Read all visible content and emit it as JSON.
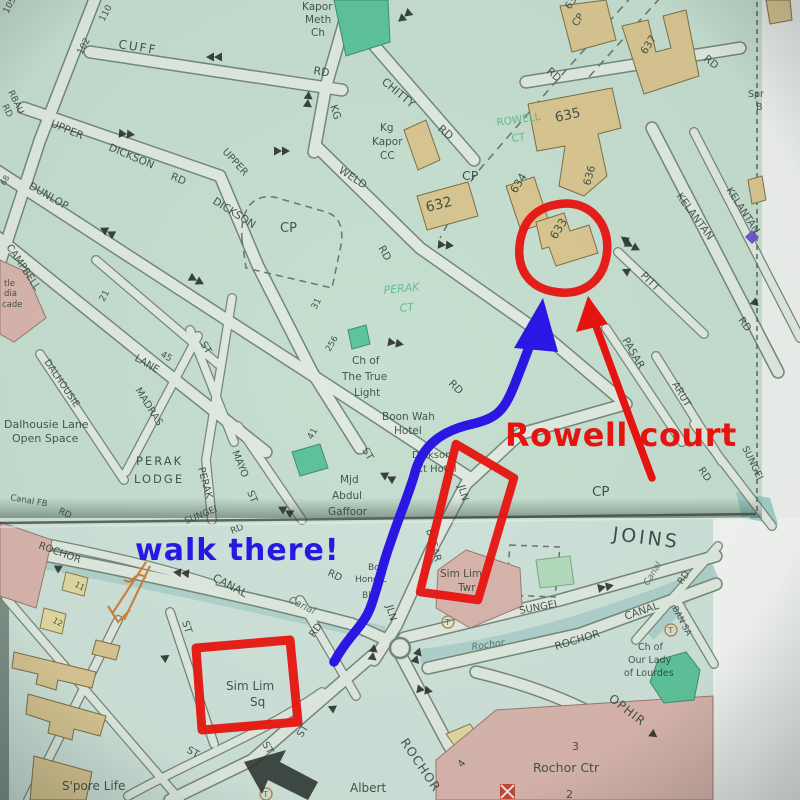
{
  "annotations": {
    "rowell_text": "Rowell court",
    "walk_text": "walk there!"
  },
  "colors": {
    "d": "#33423a",
    "g": "#58b989",
    "c": "#4d6a66",
    "j": "#2e3a35",
    "red": "#e61410",
    "blue": "#2817e2",
    "orange": "#c8772e",
    "map_bg_top": "#c6dfd0",
    "map_bg_bottom": "#cfe3da",
    "road_fill": "#e0eae0",
    "building_tan": "#d9c692",
    "building_pink": "#d9b6ae",
    "building_green": "#5ec49b"
  },
  "taxi_letter": "T",
  "taxi_stands": [
    {
      "x": 448,
      "y": 622
    },
    {
      "x": 266,
      "y": 794
    },
    {
      "x": 671,
      "y": 630
    }
  ],
  "labels": [
    {
      "t": "Kapor",
      "x": 302,
      "y": 10
    },
    {
      "t": "Meth",
      "x": 305,
      "y": 23
    },
    {
      "t": "Ch",
      "x": 311,
      "y": 36
    },
    {
      "t": "CUFF",
      "x": 118,
      "y": 48,
      "r": 9,
      "s": 12,
      "sp": 2
    },
    {
      "t": "RD",
      "x": 313,
      "y": 74,
      "r": 9,
      "s": 11
    },
    {
      "t": "110",
      "x": 104,
      "y": 22,
      "r": -62,
      "s": 9
    },
    {
      "t": "102",
      "x": 82,
      "y": 55,
      "r": -62,
      "s": 9
    },
    {
      "t": "105",
      "x": 8,
      "y": 14,
      "r": -62,
      "s": 9
    },
    {
      "t": "RBAU",
      "x": 8,
      "y": 92,
      "r": 64,
      "s": 9
    },
    {
      "t": "RD",
      "x": 2,
      "y": 106,
      "r": 64,
      "s": 9
    },
    {
      "t": "UPPER",
      "x": 50,
      "y": 126,
      "r": 23
    },
    {
      "t": "DICKSON",
      "x": 108,
      "y": 150,
      "r": 23
    },
    {
      "t": "RD",
      "x": 170,
      "y": 179,
      "r": 23
    },
    {
      "t": "UPPER",
      "x": 222,
      "y": 152,
      "r": 48,
      "s": 10
    },
    {
      "t": "DICKSON",
      "x": 212,
      "y": 203,
      "r": 32
    },
    {
      "t": "CP",
      "x": 280,
      "y": 232,
      "s": 13
    },
    {
      "t": "31",
      "x": 316,
      "y": 310,
      "r": -62,
      "s": 9
    },
    {
      "t": "DUNLOP",
      "x": 28,
      "y": 188,
      "r": 30
    },
    {
      "t": "68",
      "x": 5,
      "y": 186,
      "r": -62,
      "s": 8
    },
    {
      "t": "CAMPBELL",
      "x": 6,
      "y": 247,
      "r": 56,
      "s": 10
    },
    {
      "t": "LANE",
      "x": 134,
      "y": 360,
      "r": 30,
      "s": 10
    },
    {
      "t": "45",
      "x": 160,
      "y": 356,
      "r": 30,
      "s": 9
    },
    {
      "t": "21",
      "x": 104,
      "y": 302,
      "r": -62,
      "s": 9
    },
    {
      "t": "tle",
      "x": 4,
      "y": 286,
      "s": 8.5
    },
    {
      "t": "dia",
      "x": 4,
      "y": 296,
      "s": 8.5
    },
    {
      "t": "cade",
      "x": 2,
      "y": 307,
      "s": 8.5
    },
    {
      "t": "DALHOUSIE",
      "x": 44,
      "y": 362,
      "r": 56,
      "s": 9.5
    },
    {
      "t": "Dalhousie Lane",
      "x": 4,
      "y": 428,
      "s": 11
    },
    {
      "t": "Open Space",
      "x": 12,
      "y": 442,
      "s": 11
    },
    {
      "t": "MADRAS",
      "x": 135,
      "y": 390,
      "r": 58,
      "s": 10
    },
    {
      "t": "ST",
      "x": 200,
      "y": 344,
      "r": 58,
      "s": 10
    },
    {
      "t": "PERAK",
      "x": 136,
      "y": 465,
      "s": 11.5,
      "sp": 2
    },
    {
      "t": "LODGE",
      "x": 134,
      "y": 483,
      "s": 11.5,
      "sp": 2
    },
    {
      "t": "PERAK",
      "x": 198,
      "y": 468,
      "r": 75,
      "s": 10
    },
    {
      "t": "MAYO",
      "x": 232,
      "y": 452,
      "r": 68,
      "s": 10
    },
    {
      "t": "ST",
      "x": 247,
      "y": 492,
      "r": 68,
      "s": 10
    },
    {
      "t": "Canal FB",
      "x": 10,
      "y": 500,
      "r": 10,
      "s": 8.5
    },
    {
      "t": "RD",
      "x": 58,
      "y": 513,
      "r": 25,
      "s": 9
    },
    {
      "t": "KG",
      "x": 330,
      "y": 106,
      "r": 72
    },
    {
      "t": "CHITTY",
      "x": 381,
      "y": 83,
      "r": 40,
      "s": 11
    },
    {
      "t": "RD",
      "x": 437,
      "y": 130,
      "r": 40,
      "s": 11
    },
    {
      "t": "Kg",
      "x": 380,
      "y": 131
    },
    {
      "t": "Kapor",
      "x": 372,
      "y": 145
    },
    {
      "t": "CC",
      "x": 380,
      "y": 159
    },
    {
      "t": "WELD",
      "x": 338,
      "y": 172,
      "r": 33
    },
    {
      "t": "RD",
      "x": 378,
      "y": 248,
      "r": 60
    },
    {
      "t": "RD",
      "x": 448,
      "y": 384,
      "r": 45
    },
    {
      "t": "CP",
      "x": 462,
      "y": 180,
      "s": 12.5
    },
    {
      "t": "ROWELL",
      "x": 497,
      "y": 126,
      "r": -8,
      "c": "g",
      "s": 10.5
    },
    {
      "t": "CT",
      "x": 512,
      "y": 142,
      "r": -8,
      "c": "g",
      "s": 10.5
    },
    {
      "t": "638",
      "x": 570,
      "y": 10,
      "r": -56,
      "s": 10
    },
    {
      "t": "CP",
      "x": 577,
      "y": 27,
      "r": -56,
      "s": 10
    },
    {
      "t": "637",
      "x": 646,
      "y": 55,
      "r": -58,
      "s": 10.5
    },
    {
      "t": "RD",
      "x": 546,
      "y": 72,
      "r": 42,
      "s": 10.5
    },
    {
      "t": "RD",
      "x": 703,
      "y": 60,
      "r": 38,
      "s": 10.5
    },
    {
      "t": "635",
      "x": 556,
      "y": 122,
      "r": -12,
      "s": 13.5
    },
    {
      "t": "636",
      "x": 590,
      "y": 186,
      "r": -75,
      "s": 10.5
    },
    {
      "t": "Spr",
      "x": 748,
      "y": 97,
      "s": 9.5
    },
    {
      "t": "B",
      "x": 756,
      "y": 110,
      "s": 9.5
    },
    {
      "t": "632",
      "x": 427,
      "y": 212,
      "r": -14,
      "s": 14
    },
    {
      "t": "634",
      "x": 516,
      "y": 194,
      "r": -58,
      "s": 11
    },
    {
      "t": "633",
      "x": 556,
      "y": 240,
      "r": -58,
      "s": 11.5
    },
    {
      "t": "PERAK",
      "x": 384,
      "y": 294,
      "r": -6,
      "c": "g",
      "i": 1,
      "s": 11
    },
    {
      "t": "CT",
      "x": 400,
      "y": 312,
      "r": -6,
      "c": "g",
      "i": 1,
      "s": 11
    },
    {
      "t": "256",
      "x": 330,
      "y": 352,
      "r": -60,
      "s": 8.5
    },
    {
      "t": "Ch of",
      "x": 352,
      "y": 364
    },
    {
      "t": "The True",
      "x": 342,
      "y": 380
    },
    {
      "t": "Light",
      "x": 354,
      "y": 396
    },
    {
      "t": "Boon Wah",
      "x": 382,
      "y": 420
    },
    {
      "t": "Hotel",
      "x": 394,
      "y": 434
    },
    {
      "t": "3",
      "x": 472,
      "y": 430,
      "r": -55,
      "s": 9.5
    },
    {
      "t": "Dickson",
      "x": 412,
      "y": 458,
      "s": 10
    },
    {
      "t": "Ct Hotel",
      "x": 416,
      "y": 472,
      "s": 10
    },
    {
      "t": "Mjd",
      "x": 340,
      "y": 483
    },
    {
      "t": "Abdul",
      "x": 332,
      "y": 499
    },
    {
      "t": "Gaffoor",
      "x": 328,
      "y": 515
    },
    {
      "t": "ST",
      "x": 362,
      "y": 450,
      "r": 60,
      "s": 10
    },
    {
      "t": "41",
      "x": 312,
      "y": 440,
      "r": -60,
      "s": 9
    },
    {
      "t": "KELANTAN",
      "x": 676,
      "y": 196,
      "r": 54
    },
    {
      "t": "KELANTAN",
      "x": 726,
      "y": 190,
      "r": 57,
      "s": 10
    },
    {
      "t": "PITT",
      "x": 640,
      "y": 276,
      "r": 45
    },
    {
      "t": "PASAR",
      "x": 622,
      "y": 340,
      "r": 60
    },
    {
      "t": "RD",
      "x": 738,
      "y": 320,
      "r": 55,
      "s": 10
    },
    {
      "t": "ARUT",
      "x": 672,
      "y": 384,
      "r": 60,
      "s": 10
    },
    {
      "t": "RD",
      "x": 698,
      "y": 470,
      "r": 55,
      "s": 10
    },
    {
      "t": "SUNGEI",
      "x": 742,
      "y": 448,
      "r": 64,
      "s": 9.5
    },
    {
      "t": "CP",
      "x": 592,
      "y": 496,
      "s": 13.5
    },
    {
      "t": "JOINS",
      "x": 612,
      "y": 540,
      "r": 7,
      "s": 19,
      "sp": 3,
      "c": "j"
    },
    {
      "t": "ROCHOR",
      "x": 38,
      "y": 548,
      "r": 20,
      "s": 10
    },
    {
      "t": "SUNGEI",
      "x": 186,
      "y": 524,
      "r": -22,
      "s": 9
    },
    {
      "t": "RD",
      "x": 232,
      "y": 534,
      "r": -22,
      "s": 9
    },
    {
      "t": "CANAL",
      "x": 212,
      "y": 580,
      "r": 28,
      "s": 11
    },
    {
      "t": "Canal",
      "x": 288,
      "y": 602,
      "r": 26,
      "s": 10,
      "i": 1,
      "c": "c"
    },
    {
      "t": "RD",
      "x": 327,
      "y": 575,
      "r": 26,
      "s": 10
    },
    {
      "t": "Bo",
      "x": 368,
      "y": 570,
      "s": 9
    },
    {
      "t": "Hong L",
      "x": 355,
      "y": 582,
      "s": 9
    },
    {
      "t": "Blg",
      "x": 362,
      "y": 598,
      "s": 9
    },
    {
      "t": "JLN",
      "x": 458,
      "y": 486,
      "r": 74,
      "s": 10
    },
    {
      "t": "BESAR",
      "x": 426,
      "y": 530,
      "r": 74,
      "s": 10
    },
    {
      "t": "JLN",
      "x": 386,
      "y": 606,
      "r": 74,
      "s": 10
    },
    {
      "t": "Sim Lim",
      "x": 440,
      "y": 577
    },
    {
      "t": "Twr",
      "x": 458,
      "y": 591
    },
    {
      "t": "SUNGEI",
      "x": 520,
      "y": 614,
      "r": -11,
      "s": 10
    },
    {
      "t": "Rochor",
      "x": 472,
      "y": 650,
      "r": -8,
      "s": 9.5,
      "i": 1,
      "c": "c"
    },
    {
      "t": "ROCHOR",
      "x": 556,
      "y": 650,
      "r": -17,
      "s": 10.5
    },
    {
      "t": "CANAL",
      "x": 626,
      "y": 620,
      "r": -19,
      "s": 10.5
    },
    {
      "t": "Canal",
      "x": 648,
      "y": 586,
      "r": -58,
      "s": 9,
      "i": 1,
      "c": "c"
    },
    {
      "t": "RD",
      "x": 682,
      "y": 585,
      "r": -55,
      "s": 9.5
    },
    {
      "t": "BAN SA",
      "x": 672,
      "y": 608,
      "r": 62,
      "s": 8.5
    },
    {
      "t": "Ch of",
      "x": 638,
      "y": 650,
      "s": 9.5
    },
    {
      "t": "Our Lady",
      "x": 628,
      "y": 663,
      "s": 9.5
    },
    {
      "t": "of Lourdes",
      "x": 624,
      "y": 676,
      "s": 9.5
    },
    {
      "t": "OPHIR",
      "x": 608,
      "y": 700,
      "r": 38,
      "s": 12,
      "sp": 1
    },
    {
      "t": "ROCHOR",
      "x": 400,
      "y": 742,
      "r": 56,
      "s": 12.5,
      "sp": 1
    },
    {
      "t": "Rochor Ctr",
      "x": 533,
      "y": 772,
      "s": 12.5
    },
    {
      "t": "3",
      "x": 572,
      "y": 750,
      "s": 11
    },
    {
      "t": "2",
      "x": 566,
      "y": 798,
      "s": 11
    },
    {
      "t": "4",
      "x": 462,
      "y": 768,
      "r": -50,
      "s": 10
    },
    {
      "t": "Albert",
      "x": 350,
      "y": 792,
      "s": 12
    },
    {
      "t": "Sim Lim",
      "x": 226,
      "y": 690,
      "s": 12
    },
    {
      "t": "Sq",
      "x": 250,
      "y": 706,
      "s": 12
    },
    {
      "t": "ST",
      "x": 182,
      "y": 622,
      "r": 72,
      "s": 10
    },
    {
      "t": "RD",
      "x": 314,
      "y": 638,
      "r": -55,
      "s": 10
    },
    {
      "t": "ST",
      "x": 262,
      "y": 744,
      "r": 60,
      "s": 10
    },
    {
      "t": "ST",
      "x": 186,
      "y": 752,
      "r": 28,
      "s": 10
    },
    {
      "t": "ST",
      "x": 302,
      "y": 738,
      "r": -58,
      "s": 10
    },
    {
      "t": "S'pore Life",
      "x": 62,
      "y": 790,
      "s": 12
    },
    {
      "t": "11",
      "x": 74,
      "y": 586,
      "r": 28,
      "s": 8
    },
    {
      "t": "12",
      "x": 52,
      "y": 622,
      "r": 28,
      "s": 8
    }
  ],
  "arrows": [
    {
      "x": 215,
      "y": 57,
      "r": 180,
      "d": 1
    },
    {
      "x": 405,
      "y": 16,
      "r": 140,
      "d": 1
    },
    {
      "x": 308,
      "y": 100,
      "r": -85,
      "d": 1
    },
    {
      "x": 126,
      "y": 134,
      "r": 5,
      "d": 1
    },
    {
      "x": 281,
      "y": 151,
      "r": 0,
      "d": 1
    },
    {
      "x": 108,
      "y": 232,
      "r": 208,
      "d": 1
    },
    {
      "x": 196,
      "y": 280,
      "r": 28,
      "d": 1
    },
    {
      "x": 445,
      "y": 245,
      "r": 5,
      "d": 1
    },
    {
      "x": 632,
      "y": 246,
      "r": 28,
      "d": 1
    },
    {
      "x": 630,
      "y": 273,
      "r": 205,
      "d": 0
    },
    {
      "x": 628,
      "y": 242,
      "r": 218,
      "d": 0
    },
    {
      "x": 752,
      "y": 300,
      "r": 42,
      "d": 0
    },
    {
      "x": 395,
      "y": 343,
      "r": 10,
      "d": 1
    },
    {
      "x": 388,
      "y": 477,
      "r": 208,
      "d": 1
    },
    {
      "x": 286,
      "y": 511,
      "r": 208,
      "d": 1
    },
    {
      "x": 182,
      "y": 573,
      "r": 186,
      "d": 1
    },
    {
      "x": 605,
      "y": 587,
      "r": -12,
      "d": 1
    },
    {
      "x": 55,
      "y": 570,
      "r": -28,
      "d": 0
    },
    {
      "x": 373,
      "y": 653,
      "r": -82,
      "d": 1
    },
    {
      "x": 417,
      "y": 656,
      "r": -72,
      "d": 1
    },
    {
      "x": 424,
      "y": 690,
      "r": 10,
      "d": 1
    },
    {
      "x": 336,
      "y": 710,
      "r": 205,
      "d": 0
    },
    {
      "x": 650,
      "y": 732,
      "r": 36,
      "d": 0
    },
    {
      "x": 162,
      "y": 660,
      "r": -35,
      "d": 0
    }
  ]
}
